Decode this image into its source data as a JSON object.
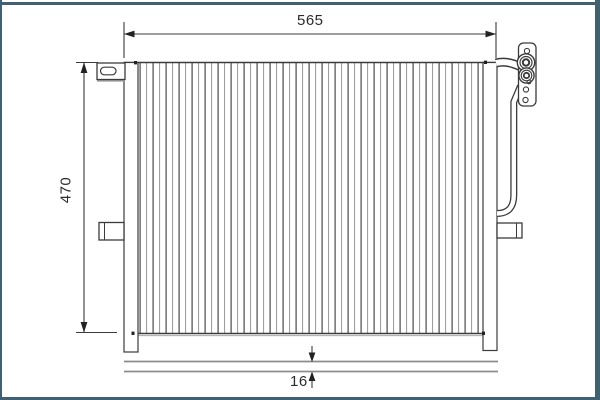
{
  "figure": {
    "dimensions": {
      "width": "565",
      "height": "470",
      "depth": "16"
    },
    "colors": {
      "frame": "#406171",
      "outline": "#3b3b3b",
      "fin_light": "#9c9c9c",
      "side_view_band": "#8c8c8c",
      "background": "#ffffff"
    }
  }
}
